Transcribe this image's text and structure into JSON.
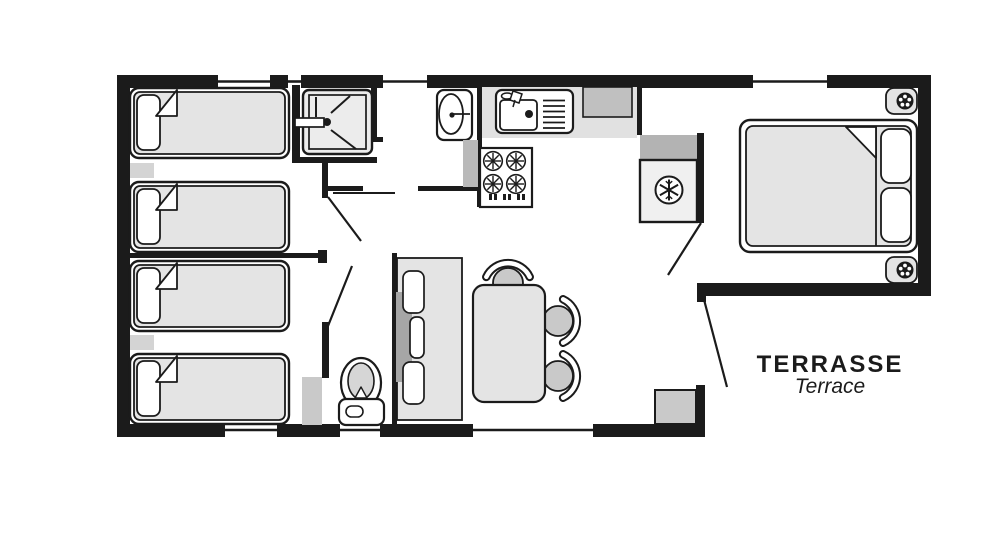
{
  "plan": {
    "terrace": {
      "title": "TERRASSE",
      "subtitle": "Terrace"
    },
    "colors": {
      "wall": "#1b1b1b",
      "background": "#ffffff",
      "furniture_light_gray": "#e4e4e4",
      "counter_gray": "#e1e1e1",
      "cabinet_gray": "#b9b9b9",
      "appliance_gray": "#c0c0c0",
      "seat_gray": "#c9c9c9",
      "bench_back_gray": "#a6a6a6"
    },
    "icons": {
      "fridge": "snowflake-icon",
      "shower": "shower-spray-icon",
      "stove": "stove-burner-icon",
      "nightstand": "reading-light-icon",
      "toilet": "toilet-icon"
    }
  }
}
